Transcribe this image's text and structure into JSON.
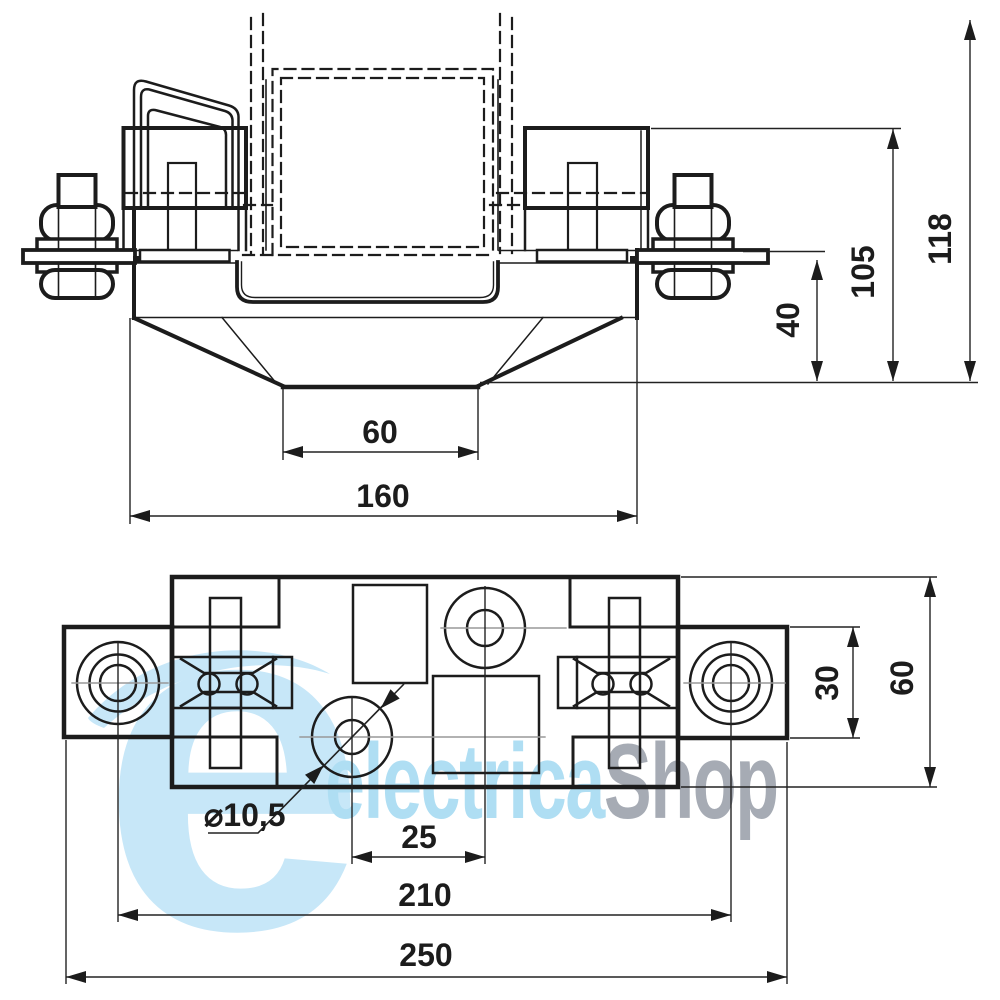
{
  "watermark": {
    "brand_first": "electrica",
    "brand_second": "Shop",
    "blue": "#afdef3",
    "gray": "#a6abb4",
    "logo_blue": "#c7e7f8"
  },
  "front_view": {
    "dims": {
      "base_width": "60",
      "overall_width": "160",
      "busbar_height": "40",
      "clamp_height": "105",
      "overall_height": "118"
    }
  },
  "plan_view": {
    "dims": {
      "hole_spacing": "25",
      "mount_spacing": "210",
      "overall_length": "250",
      "pad_width": "30",
      "body_depth": "60",
      "hole_diameter": "⌀10,5"
    }
  }
}
